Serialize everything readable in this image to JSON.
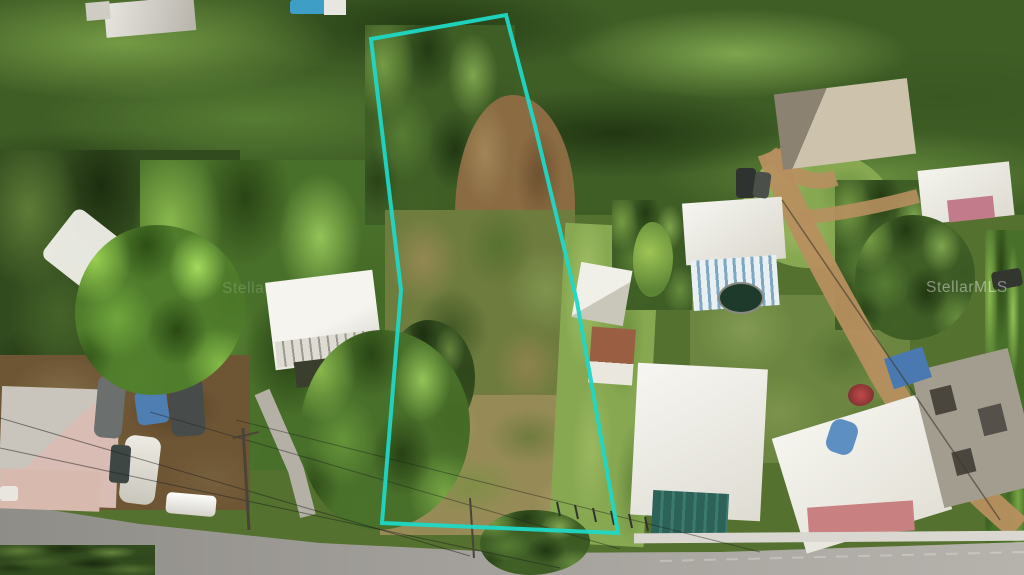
{
  "watermarks": {
    "left": "StellarMLS",
    "right": "StellarMLS"
  },
  "overlay": {
    "boundary_color": "#1FD8C6",
    "boundary_points": "371,39 506,15 534,122 577,302 618,533 382,523 401,290"
  }
}
